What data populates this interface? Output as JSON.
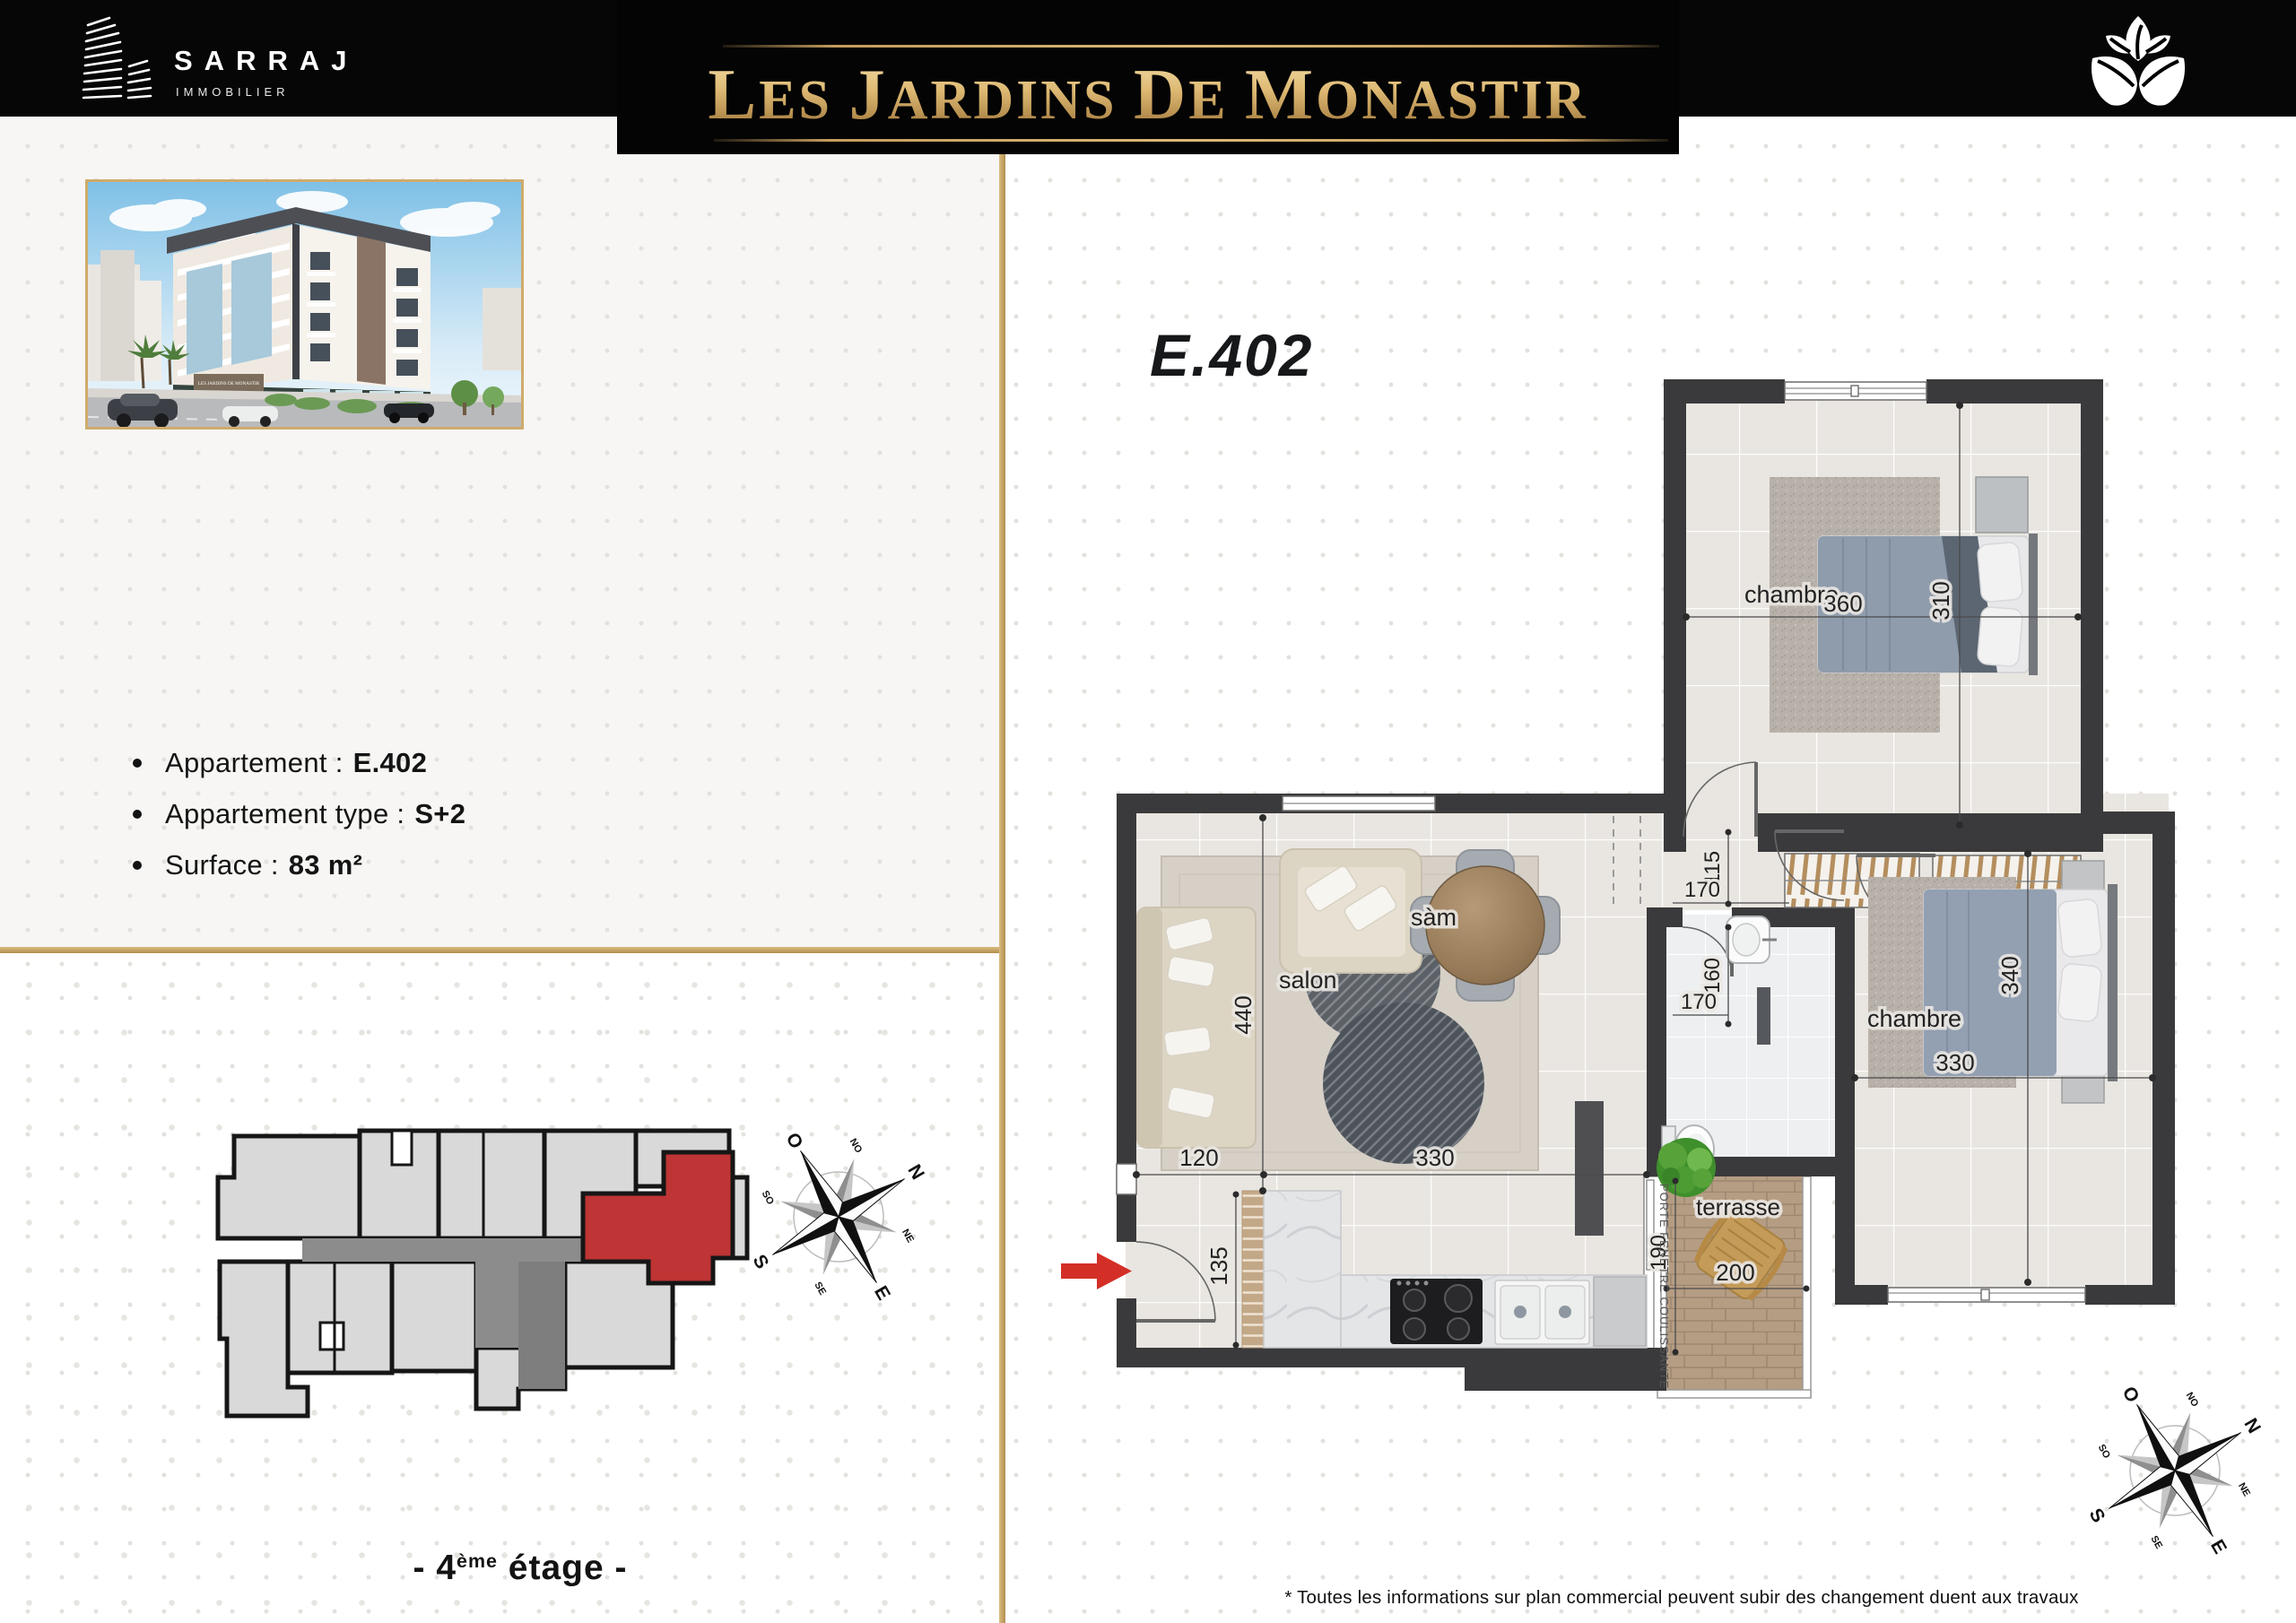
{
  "header": {
    "brand_name": "SARRAJ",
    "brand_subtitle": "IMMOBILIER",
    "title": "LES JARDINS DE MONASTIR"
  },
  "unit": {
    "plan_title": "E.402",
    "details": [
      {
        "label": "Appartement :",
        "value": "E.402"
      },
      {
        "label": "Appartement type :",
        "value": "S+2"
      },
      {
        "label": "Surface :",
        "value": "83 m²"
      }
    ],
    "floor_caption": {
      "prefix": "- 4",
      "sup": "ème",
      "suffix": " étage -"
    }
  },
  "plan": {
    "rooms": {
      "chambre1": "chambre",
      "chambre2": "chambre",
      "salon": "salon",
      "sam": "sàm",
      "terrasse": "terrasse"
    },
    "dims": {
      "chambre1_w": "360",
      "chambre1_h": "310",
      "hall_w": "115",
      "bath_w_top": "170",
      "bath_h": "160",
      "bath_w_bottom": "170",
      "salon_h": "440",
      "entry_w": "120",
      "kitchen_w": "330",
      "kitchen_h": "135",
      "terrasse_h": "190",
      "terrasse_w": "200",
      "chambre2_w": "330",
      "chambre2_h": "340"
    },
    "sliding_door_label": "PORTE FENETRE COULISSANTE"
  },
  "compass": {
    "n": "N",
    "ne": "NE",
    "e": "E",
    "se": "SE",
    "s": "S",
    "so": "SO",
    "o": "O",
    "no": "NO"
  },
  "footer": {
    "disclaimer": "* Toutes les informations sur plan commercial peuvent subir des changement duent aux travaux"
  }
}
